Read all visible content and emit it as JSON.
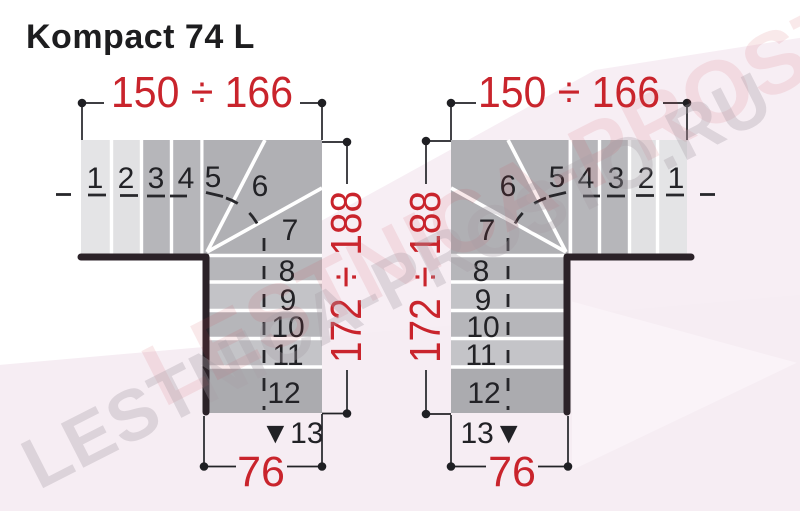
{
  "title": "Kompact 74 L",
  "watermark": {
    "text": "LESTNICA-PROSTO.RU"
  },
  "colors": {
    "dimension_red": "#c9242c",
    "wall_black": "#2b2228",
    "step_light": "#e4e4e6",
    "step_mid": "#b6b6ba",
    "step_mid_alt": "#c3c3c7",
    "step_dark": "#ababaf",
    "wedge_gray": "#b0b0b4",
    "background_pink": "#f6edf3"
  },
  "left_stair": {
    "width_label": "150 ÷ 166",
    "height_label": "172 ÷ 188",
    "exit_width_label": "76",
    "steps": [
      "1",
      "2",
      "3",
      "4",
      "5",
      "6",
      "7",
      "8",
      "9",
      "10",
      "11",
      "12"
    ],
    "last_step_label": "▼13"
  },
  "right_stair": {
    "width_label": "150 ÷ 166",
    "height_label": "172 ÷ 188",
    "exit_width_label": "76",
    "steps": [
      "1",
      "2",
      "3",
      "4",
      "5",
      "6",
      "7",
      "8",
      "9",
      "10",
      "11",
      "12"
    ],
    "last_step_label": "13▼"
  }
}
